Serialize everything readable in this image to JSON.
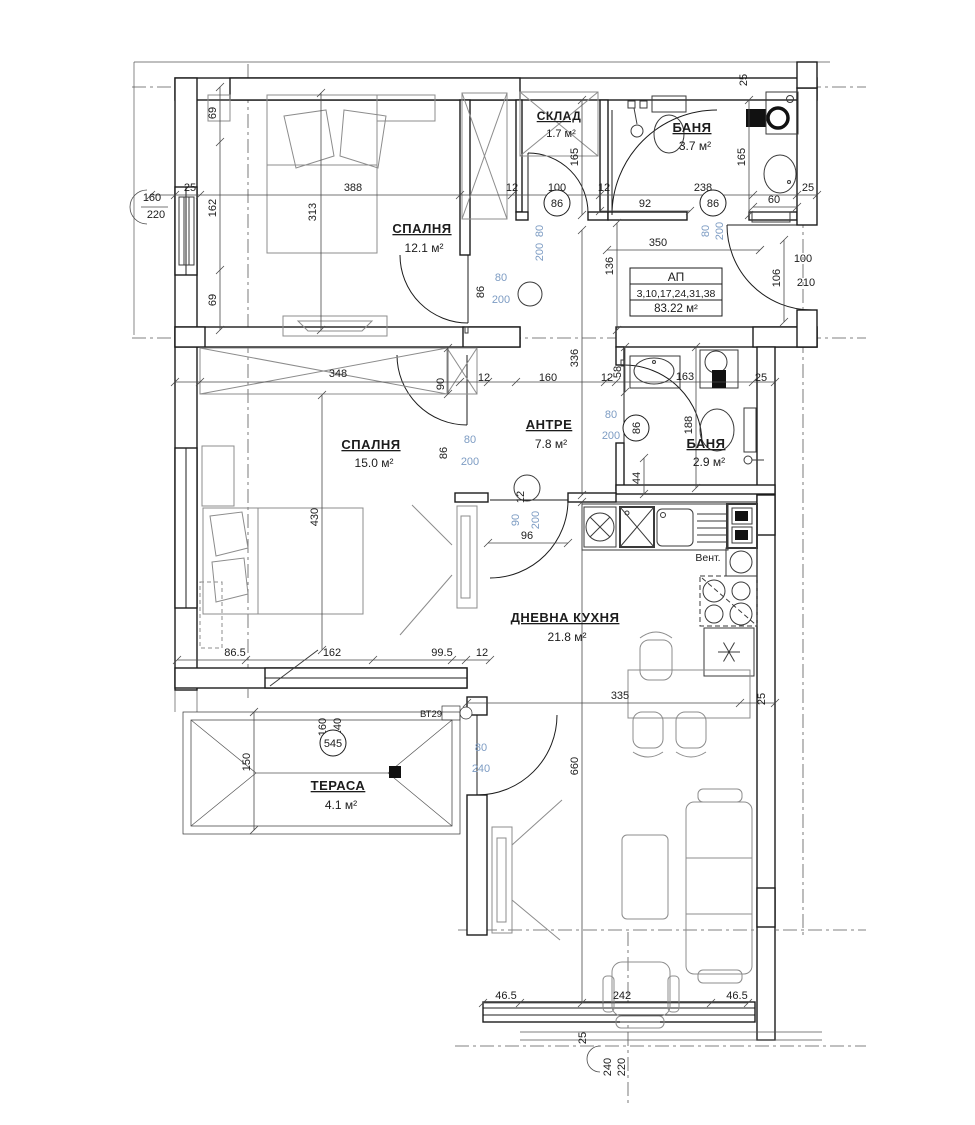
{
  "drawing": {
    "title": "apartment-floor-plan",
    "colors": {
      "ink": "#1c1c1c",
      "furniture": "#8c8c8c",
      "door_size_label": "#7d9cc3",
      "axis": "#5a5a5a",
      "accent_green": "#2fae2f"
    },
    "rooms": [
      {
        "id": "bedroom-1",
        "name": "СПАЛНЯ",
        "area": "12.1 м²"
      },
      {
        "id": "storage",
        "name": "СКЛАД",
        "area": "1.7 м²"
      },
      {
        "id": "bathroom-1",
        "name": "БАНЯ",
        "area": "3.7 м²"
      },
      {
        "id": "hallway",
        "name": "АНТРЕ",
        "area": "7.8 м²"
      },
      {
        "id": "bathroom-2",
        "name": "БАНЯ",
        "area": "2.9 м²"
      },
      {
        "id": "bedroom-2",
        "name": "СПАЛНЯ",
        "area": "15.0 м²"
      },
      {
        "id": "living-kitchen",
        "name": "ДНЕВНА КУХНЯ",
        "area": "21.8 м²"
      },
      {
        "id": "terrace",
        "name": "ТЕРАСА",
        "area": "4.1 м²"
      }
    ],
    "apartment_card": {
      "title": "АП",
      "units": "3,10,17,24,31,38",
      "area": "83.22 м²"
    },
    "annotations": [
      {
        "id": "vent",
        "text": "Вент."
      },
      {
        "id": "bt29",
        "text": "ВТ29"
      }
    ],
    "dimension_labels": [
      {
        "t": "25",
        "x": 190,
        "y": 191
      },
      {
        "t": "388",
        "x": 353,
        "y": 191
      },
      {
        "t": "12",
        "x": 512,
        "y": 191
      },
      {
        "t": "100",
        "x": 557,
        "y": 191
      },
      {
        "t": "12",
        "x": 604,
        "y": 191
      },
      {
        "t": "238",
        "x": 703,
        "y": 191
      },
      {
        "t": "25",
        "x": 808,
        "y": 191
      },
      {
        "t": "92",
        "x": 645,
        "y": 207
      },
      {
        "t": "60",
        "x": 774,
        "y": 203
      },
      {
        "t": "86",
        "x": 557,
        "y": 207,
        "c": true
      },
      {
        "t": "86",
        "x": 713,
        "y": 207,
        "c": true
      },
      {
        "t": "69",
        "x": 216,
        "y": 113,
        "r": true
      },
      {
        "t": "162",
        "x": 216,
        "y": 208,
        "r": true
      },
      {
        "t": "69",
        "x": 216,
        "y": 300,
        "r": true
      },
      {
        "t": "313",
        "x": 316,
        "y": 212,
        "r": true
      },
      {
        "t": "165",
        "x": 578,
        "y": 157,
        "r": true
      },
      {
        "t": "165",
        "x": 745,
        "y": 157,
        "r": true
      },
      {
        "t": "25",
        "x": 747,
        "y": 80,
        "r": true
      },
      {
        "t": "160",
        "x": 152,
        "y": 201
      },
      {
        "t": "220",
        "x": 156,
        "y": 218
      },
      {
        "t": "80",
        "x": 543,
        "y": 231,
        "r": true,
        "b": true
      },
      {
        "t": "200",
        "x": 543,
        "y": 252,
        "r": true,
        "b": true
      },
      {
        "t": "80",
        "x": 501,
        "y": 281,
        "b": true
      },
      {
        "t": "200",
        "x": 501,
        "y": 303,
        "b": true
      },
      {
        "t": "86",
        "x": 484,
        "y": 292,
        "r": true
      },
      {
        "t": "80",
        "x": 709,
        "y": 231,
        "r": true,
        "b": true
      },
      {
        "t": "200",
        "x": 723,
        "y": 231,
        "r": true,
        "b": true
      },
      {
        "t": "350",
        "x": 658,
        "y": 246
      },
      {
        "t": "136",
        "x": 613,
        "y": 266,
        "r": true
      },
      {
        "t": "100",
        "x": 803,
        "y": 262
      },
      {
        "t": "210",
        "x": 806,
        "y": 286
      },
      {
        "t": "106",
        "x": 780,
        "y": 278,
        "r": true
      },
      {
        "t": "336",
        "x": 578,
        "y": 358,
        "r": true
      },
      {
        "t": "348",
        "x": 338,
        "y": 377
      },
      {
        "t": "90",
        "x": 444,
        "y": 384,
        "r": true
      },
      {
        "t": "12",
        "x": 484,
        "y": 381
      },
      {
        "t": "160",
        "x": 548,
        "y": 381
      },
      {
        "t": "12",
        "x": 607,
        "y": 381
      },
      {
        "t": "58",
        "x": 621,
        "y": 372,
        "r": true
      },
      {
        "t": "163",
        "x": 685,
        "y": 380
      },
      {
        "t": "25",
        "x": 761,
        "y": 381
      },
      {
        "t": "12",
        "x": 524,
        "y": 497,
        "r": true
      },
      {
        "t": "80",
        "x": 611,
        "y": 418,
        "b": true
      },
      {
        "t": "200",
        "x": 611,
        "y": 439,
        "b": true
      },
      {
        "t": "86",
        "x": 640,
        "y": 428,
        "r": true,
        "c": true
      },
      {
        "t": "188",
        "x": 692,
        "y": 425,
        "r": true
      },
      {
        "t": "44",
        "x": 640,
        "y": 478,
        "r": true
      },
      {
        "t": "80",
        "x": 470,
        "y": 443,
        "b": true
      },
      {
        "t": "200",
        "x": 470,
        "y": 465,
        "b": true
      },
      {
        "t": "86",
        "x": 447,
        "y": 453,
        "r": true
      },
      {
        "t": "430",
        "x": 318,
        "y": 517,
        "r": true
      },
      {
        "t": "90",
        "x": 519,
        "y": 520,
        "r": true,
        "b": true
      },
      {
        "t": "200",
        "x": 539,
        "y": 520,
        "r": true,
        "b": true
      },
      {
        "t": "96",
        "x": 527,
        "y": 539
      },
      {
        "t": "86.5",
        "x": 235,
        "y": 656
      },
      {
        "t": "162",
        "x": 332,
        "y": 656
      },
      {
        "t": "99.5",
        "x": 442,
        "y": 656
      },
      {
        "t": "12",
        "x": 482,
        "y": 656
      },
      {
        "t": "335",
        "x": 620,
        "y": 699
      },
      {
        "t": "25",
        "x": 765,
        "y": 699,
        "r": true
      },
      {
        "t": "660",
        "x": 578,
        "y": 766,
        "r": true
      },
      {
        "t": "160",
        "x": 326,
        "y": 727,
        "r": true
      },
      {
        "t": "240",
        "x": 341,
        "y": 727,
        "r": true
      },
      {
        "t": "545",
        "x": 333,
        "y": 747,
        "c": true
      },
      {
        "t": "150",
        "x": 250,
        "y": 762,
        "r": true
      },
      {
        "t": "80",
        "x": 481,
        "y": 751,
        "b": true
      },
      {
        "t": "240",
        "x": 481,
        "y": 772,
        "b": true
      },
      {
        "t": "46.5",
        "x": 506,
        "y": 999
      },
      {
        "t": "242",
        "x": 622,
        "y": 999
      },
      {
        "t": "46.5",
        "x": 737,
        "y": 999
      },
      {
        "t": "25",
        "x": 586,
        "y": 1038,
        "r": true
      },
      {
        "t": "240",
        "x": 611,
        "y": 1067,
        "r": true
      },
      {
        "t": "220",
        "x": 625,
        "y": 1067,
        "r": true
      }
    ]
  }
}
